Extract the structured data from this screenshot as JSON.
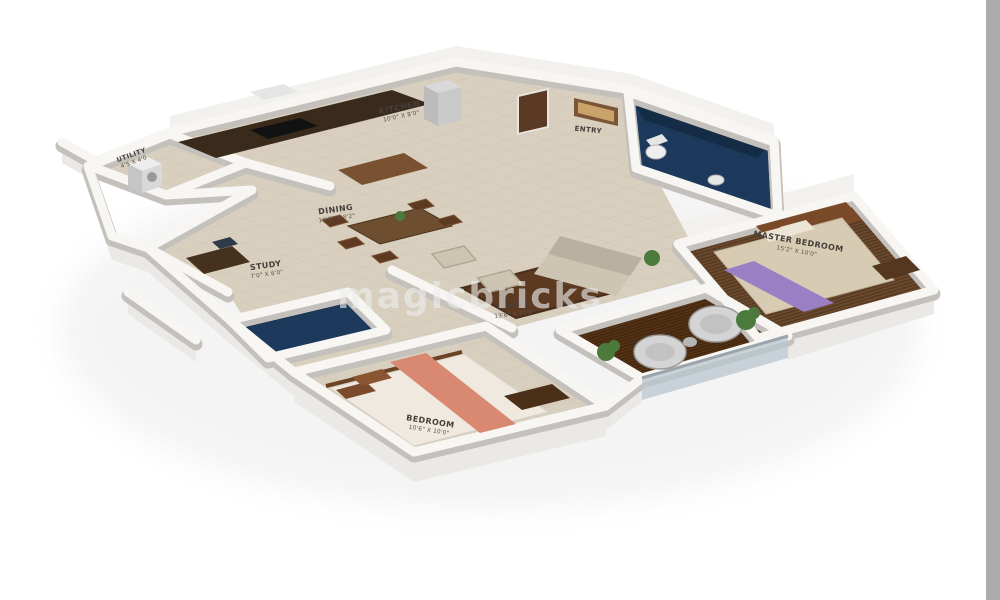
{
  "watermark": "magicbricks",
  "rooms": {
    "utility": {
      "name": "UTILITY",
      "dims": "4'5 X 4'0"
    },
    "kitchen": {
      "name": "KITCHEN",
      "dims": "10'0\" X 8'0\""
    },
    "entry": {
      "name": "ENTRY",
      "dims": ""
    },
    "dining": {
      "name": "DINING",
      "dims": "10'6\" X 8'2\""
    },
    "study": {
      "name": "STUDY",
      "dims": "7'0\" X 6'0\""
    },
    "living": {
      "name": "LIVING",
      "dims": "13'6\" X 11'6\""
    },
    "master_bedroom": {
      "name": "MASTER BEDROOM",
      "dims": "15'2\" X 10'0\""
    },
    "bedroom": {
      "name": "BEDROOM",
      "dims": "10'6\" X 10'0\""
    }
  },
  "colors": {
    "background": "#ffffff",
    "wall_top": "#f7f6f3",
    "wall_shadow": "#c4c1bc",
    "floor_tile": "#d8cfbf",
    "wood_floor": "#5f4026",
    "deck_wood": "#46290f",
    "bath_tile": "#1d3a5d",
    "master_bed_runner": "#9b7fc4",
    "bedroom_runner": "#d98872",
    "sofa": "#cdc4b2",
    "rug": "#5c3a22",
    "plant": "#4c7a3c",
    "label_text": "#45403a",
    "right_edge_bar": "#ababab"
  }
}
